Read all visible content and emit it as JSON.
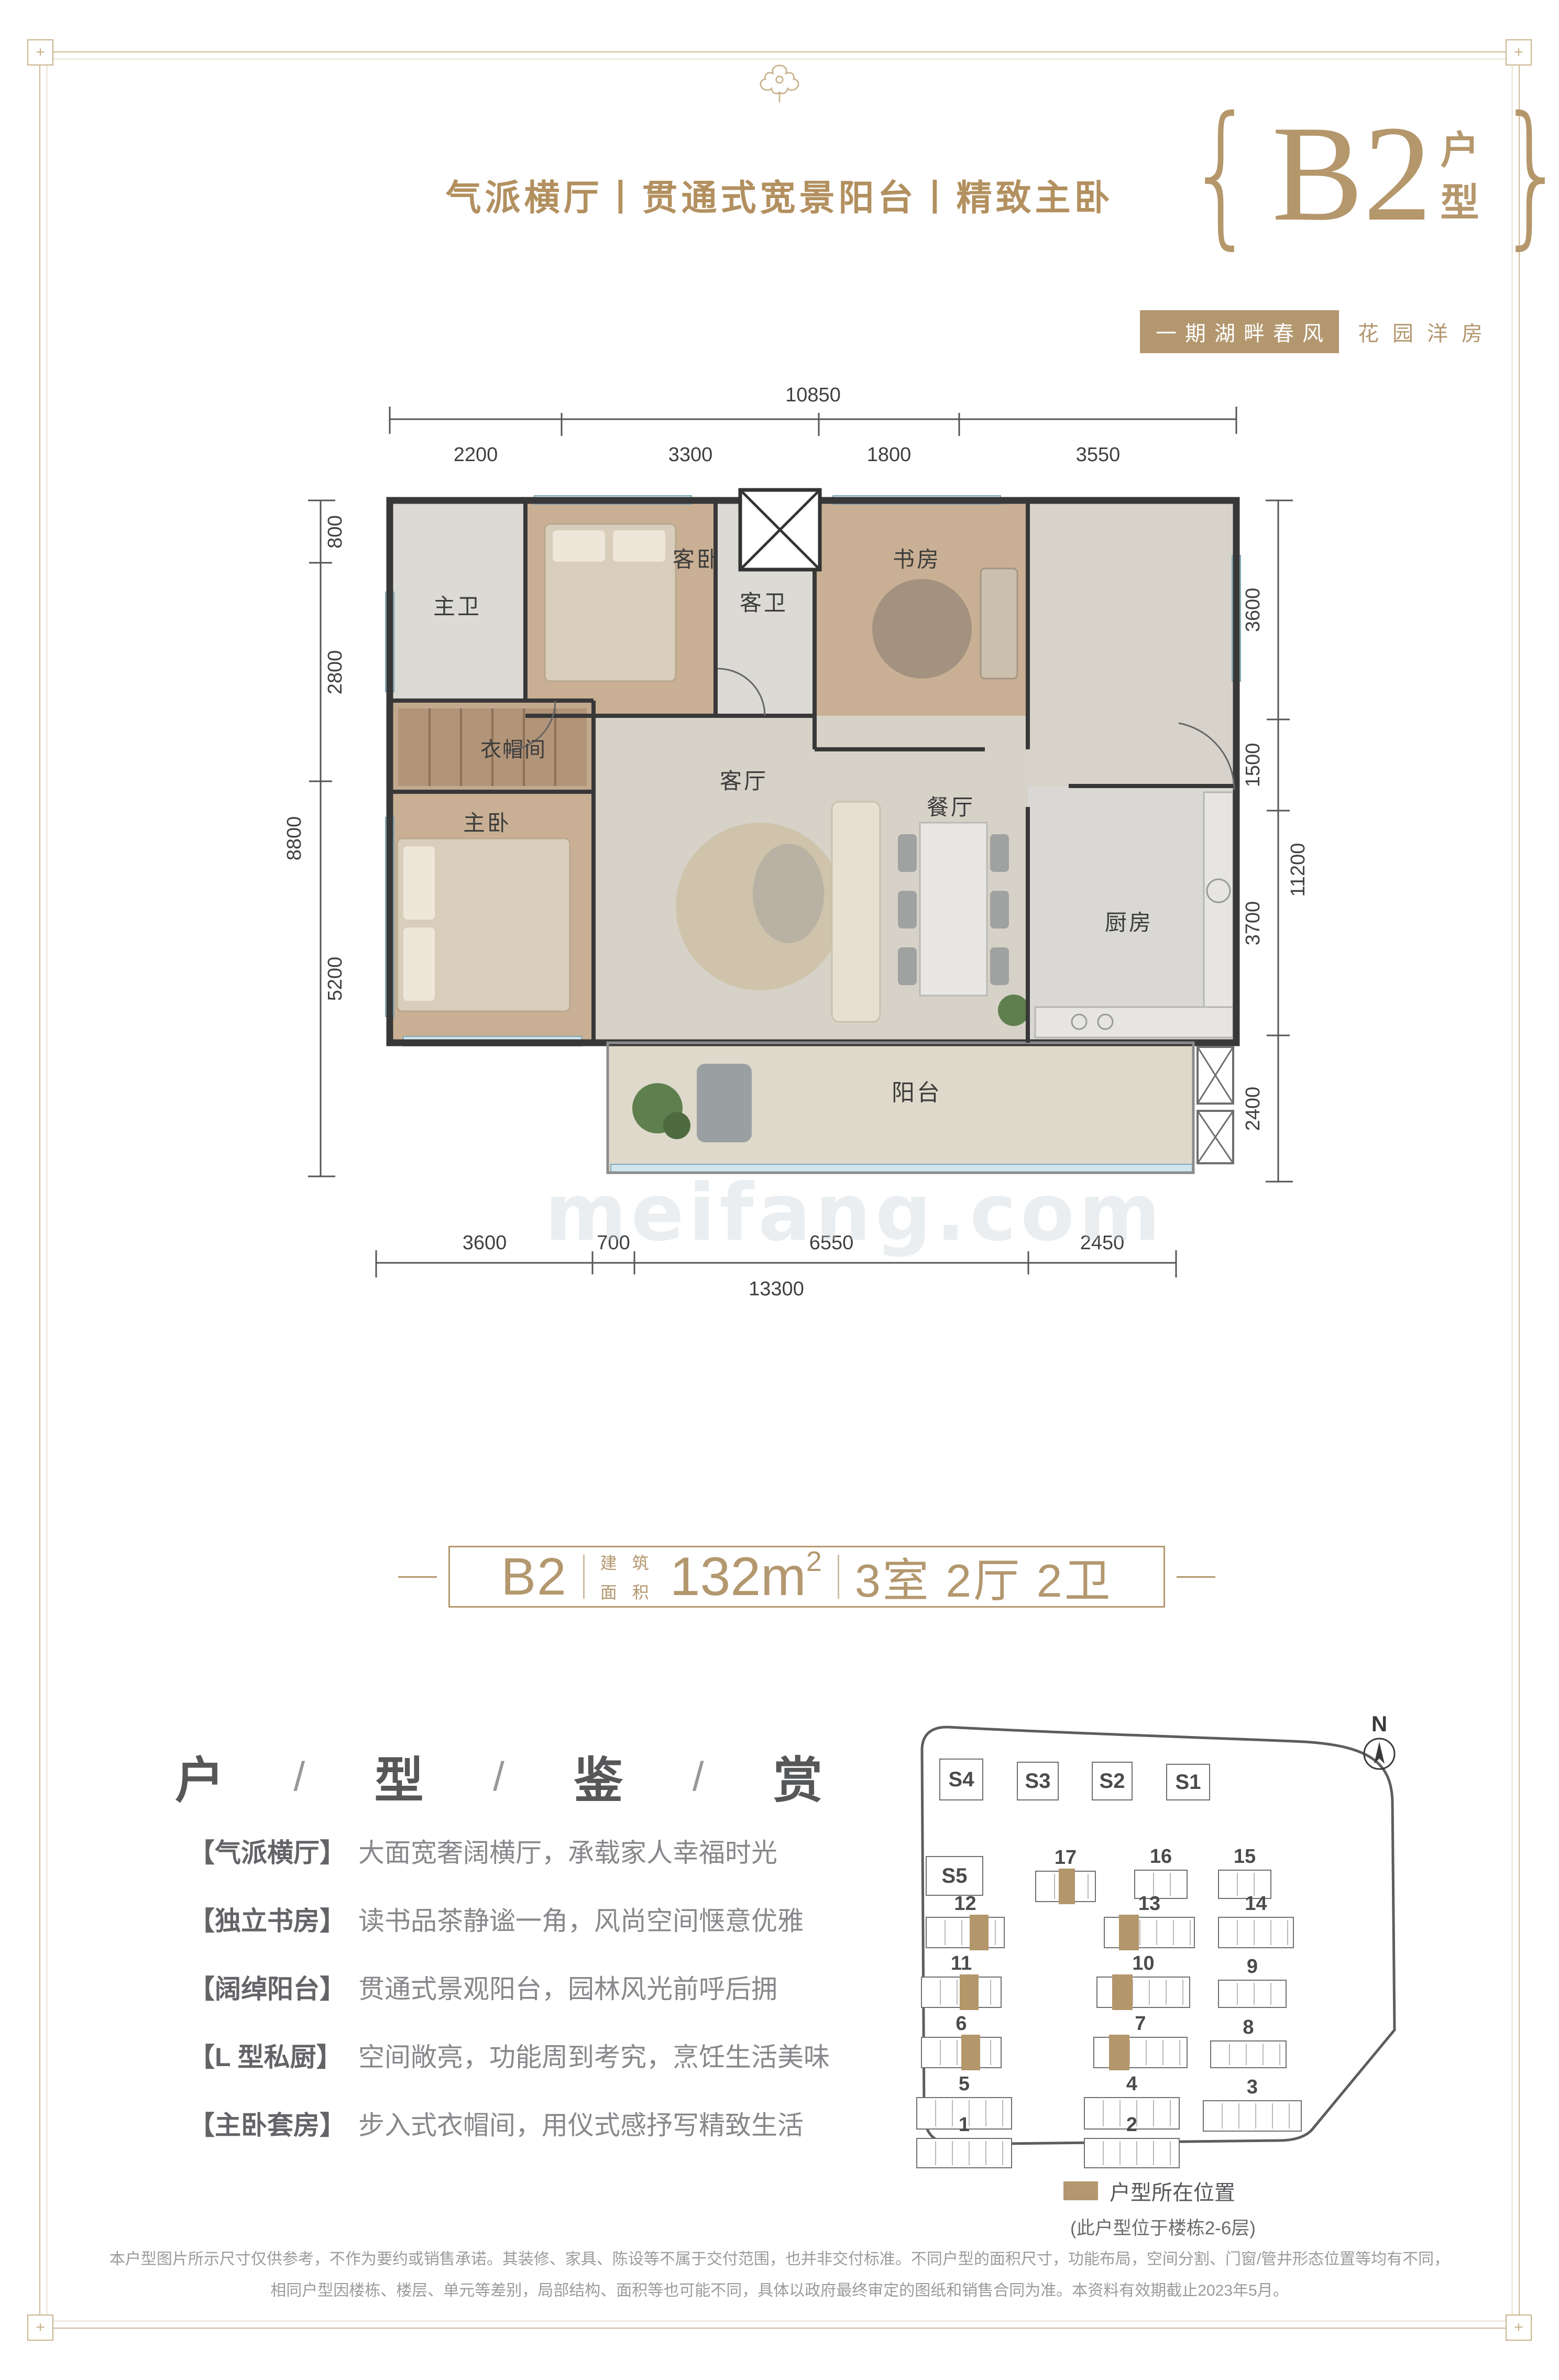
{
  "colors": {
    "accent": "#b3976e",
    "frame_gold": "#c9b28b",
    "heading_gray": "#58595b",
    "body_gray": "#85868a"
  },
  "header": {
    "tagline": "气派横厅丨贯通式宽景阳台丨精致主卧",
    "unit_code": "B2",
    "unit_suffix": [
      "户",
      "型"
    ],
    "brace_left": "{",
    "brace_right": "}",
    "project_badge_boxed": "一期湖畔春风",
    "project_badge_plain": "花园洋房"
  },
  "floor_plan": {
    "watermark": "meifang.com",
    "rooms": [
      {
        "name": "主卫"
      },
      {
        "name": "客卧"
      },
      {
        "name": "客卫"
      },
      {
        "name": "书房"
      },
      {
        "name": "衣帽间"
      },
      {
        "name": "主卧"
      },
      {
        "name": "客厅"
      },
      {
        "name": "餐厅"
      },
      {
        "name": "厨房"
      },
      {
        "name": "阳台"
      }
    ],
    "dims": {
      "top": {
        "total": "10850",
        "segments": [
          "2200",
          "3300",
          "1800",
          "3550"
        ]
      },
      "left": {
        "total": "8800",
        "segments": [
          "800",
          "2800",
          "5200"
        ]
      },
      "right": {
        "total": "11200",
        "segments": [
          "3600",
          "1500",
          "3700",
          "2400"
        ]
      },
      "bottom": {
        "total": "13300",
        "segments": [
          "3600",
          "700",
          "6550",
          "2450"
        ]
      }
    }
  },
  "summary_banner": {
    "code": "B2",
    "area_label_line1": "建 筑",
    "area_label_line2": "面 积",
    "area_value": "132m",
    "area_sup": "2",
    "layout": "3室 2厅 2卫"
  },
  "section": {
    "heading_chars": [
      "户",
      "型",
      "鉴",
      "赏"
    ],
    "separator": "/"
  },
  "features": [
    {
      "tag": "【气派横厅】",
      "desc": "大面宽奢阔横厅，承载家人幸福时光"
    },
    {
      "tag": "【独立书房】",
      "desc": "读书品茶静谧一角，风尚空间惬意优雅"
    },
    {
      "tag": "【阔绰阳台】",
      "desc": "贯通式景观阳台，园林风光前呼后拥"
    },
    {
      "tag": "【L 型私厨】",
      "desc": "空间敞亮，功能周到考究，烹饪生活美味"
    },
    {
      "tag": "【主卧套房】",
      "desc": "步入式衣帽间，用仪式感抒写精致生活"
    }
  ],
  "site_plan": {
    "north_label": "N",
    "buildings": [
      {
        "label": "S4"
      },
      {
        "label": "S3"
      },
      {
        "label": "S2"
      },
      {
        "label": "S1"
      },
      {
        "label": "S5"
      },
      {
        "label": "17"
      },
      {
        "label": "16"
      },
      {
        "label": "15"
      },
      {
        "label": "12"
      },
      {
        "label": "13"
      },
      {
        "label": "14"
      },
      {
        "label": "11"
      },
      {
        "label": "10"
      },
      {
        "label": "9"
      },
      {
        "label": "6"
      },
      {
        "label": "7"
      },
      {
        "label": "8"
      },
      {
        "label": "5"
      },
      {
        "label": "4"
      },
      {
        "label": "3"
      },
      {
        "label": "1"
      },
      {
        "label": "2"
      }
    ],
    "highlighted_buildings": [
      "17",
      "12",
      "13",
      "11",
      "10",
      "6",
      "7"
    ],
    "legend": {
      "swatch_label": "户型所在位置",
      "note": "(此户型位于楼栋2-6层)"
    }
  },
  "disclaimer": {
    "line1": "本户型图片所示尺寸仅供参考，不作为要约或销售承诺。其装修、家具、陈设等不属于交付范围，也并非交付标准。不同户型的面积尺寸，功能布局，空间分割、门窗/管井形态位置等均有不同，",
    "line2": "相同户型因楼栋、楼层、单元等差别，局部结构、面积等也可能不同，具体以政府最终审定的图纸和销售合同为准。本资料有效期截止2023年5月。"
  }
}
